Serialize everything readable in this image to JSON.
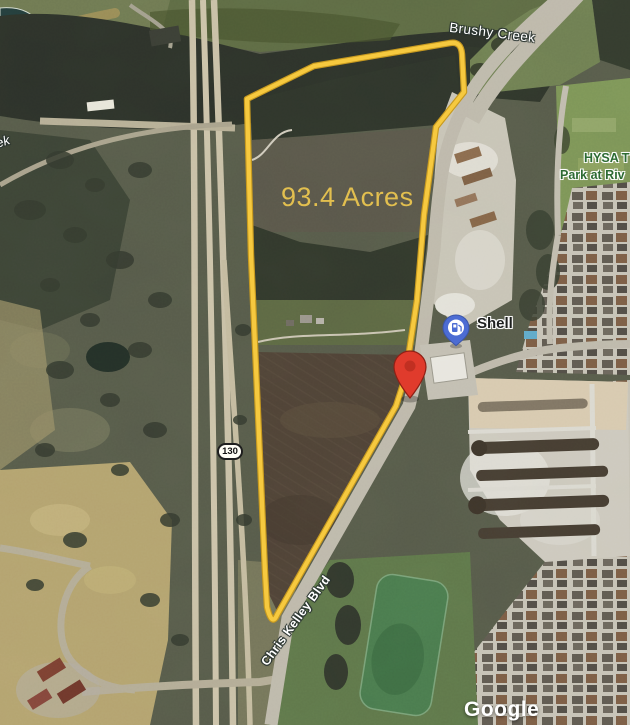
{
  "map": {
    "parcel": {
      "area_label": "93.4 Acres",
      "outline_color": "#f3c63e",
      "area_text_color": "#e2bf4f"
    },
    "labels": {
      "creek": "Brushy Creek",
      "creek_fragment": "ek",
      "park_name_line1": "HYSA T",
      "park_name_line2": "Park at Riv",
      "gas_station": "Shell",
      "route_shield": "130",
      "road_name": "Chris Kelley Blvd",
      "watermark": "Google"
    },
    "pins": {
      "destination_pin_color": "#e03b2c",
      "gas_station_pin_color": "#4c6cd3"
    },
    "colors": {
      "water_label_text": "#ffffff",
      "park_label_text": "#2d6b33",
      "terrain_base": "#565a4a",
      "road_fill": "#c4bca6"
    }
  }
}
